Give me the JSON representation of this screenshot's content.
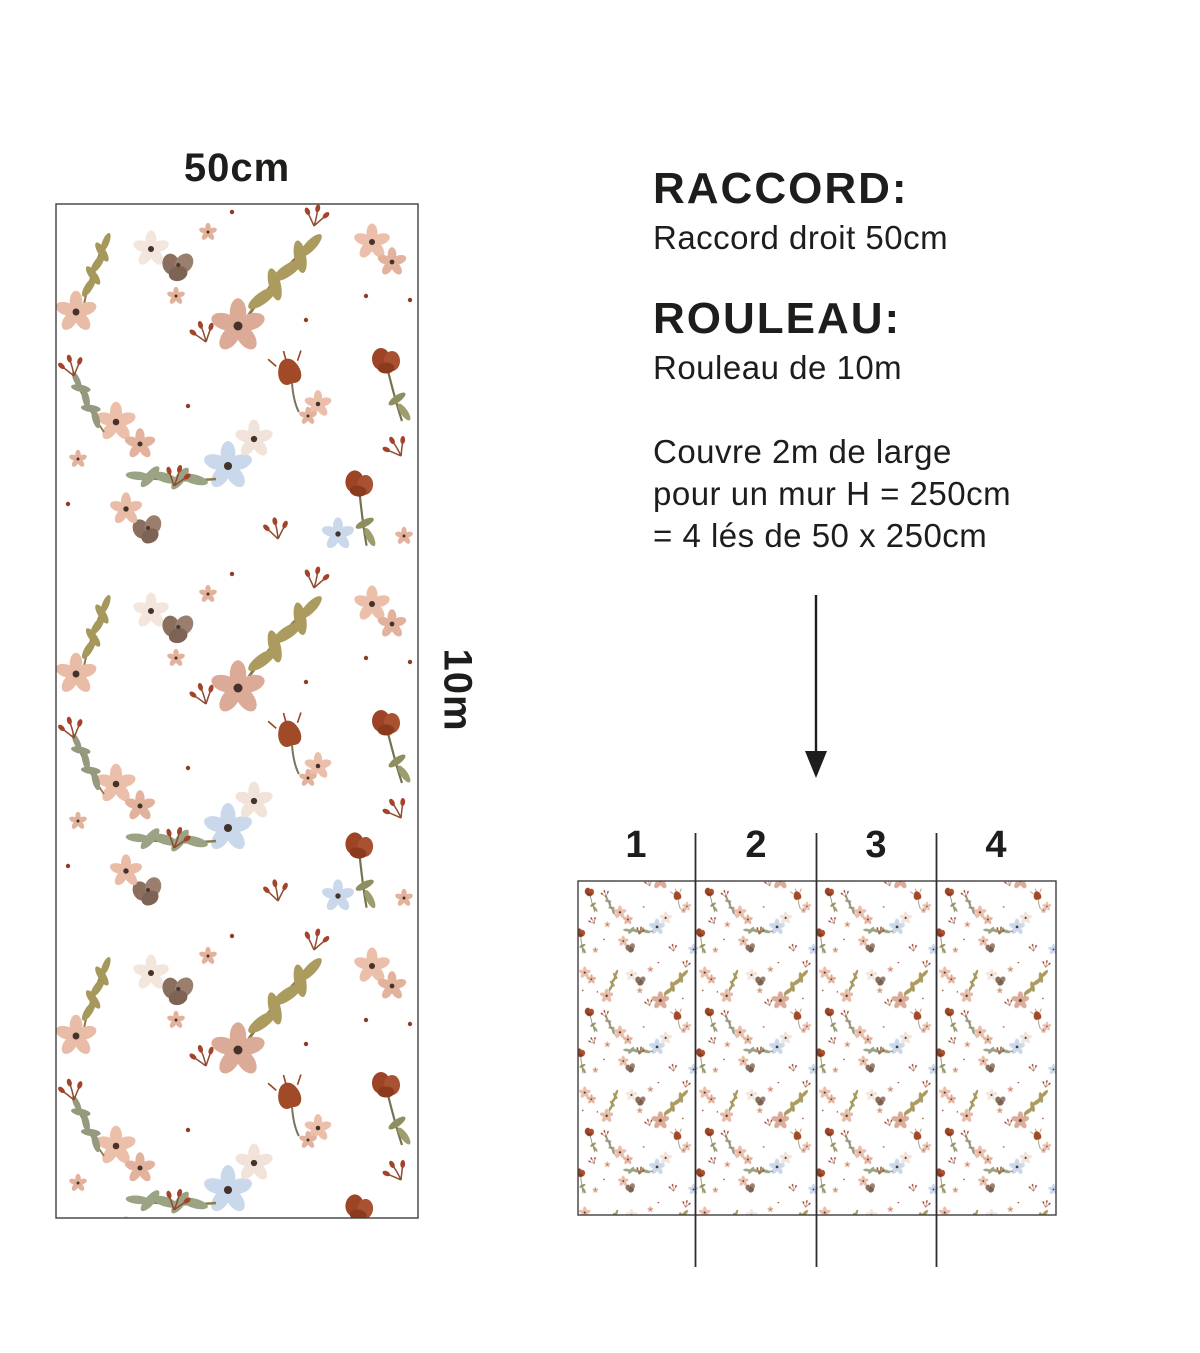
{
  "roll": {
    "width_label": "50cm",
    "length_label": "10m"
  },
  "info": {
    "raccord_title": "RACCORD:",
    "raccord_value": "Raccord droit 50cm",
    "rouleau_title": "ROULEAU:",
    "rouleau_value": "Rouleau de 10m",
    "coverage_lines": [
      "Couvre 2m de large",
      "pour un mur H = 250cm",
      "= 4 lés de 50 x 250cm"
    ]
  },
  "wall_preview": {
    "strip_labels": [
      "1",
      "2",
      "3",
      "4"
    ]
  },
  "icons": {
    "down_arrow": "↓"
  },
  "colors": {
    "background": "#ffffff",
    "ink": "#1d1d1b",
    "line": "#2e2e2e",
    "border": "#3f3f3f",
    "pattern_rust": "#9c4425",
    "pattern_rust_dark": "#8b3a1e",
    "pattern_blush": "#e9bca7",
    "pattern_pale_pink": "#dcab97",
    "pattern_olive": "#a6985b",
    "pattern_sage": "#97997f",
    "pattern_blue": "#c9d8ea",
    "pattern_taupe": "#8a6f5f",
    "pattern_cream": "#f2e6dd"
  }
}
